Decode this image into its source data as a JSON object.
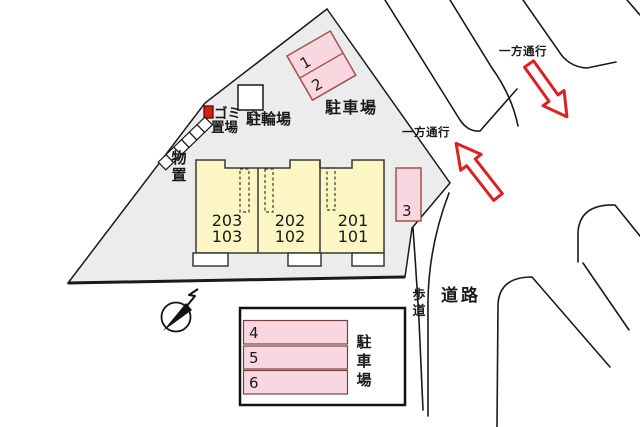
{
  "title": "site-plan",
  "colors": {
    "property_fill": "#ececec",
    "unit_fill": "#fcf6c5",
    "stall_fill": "#f8d7e1",
    "stall_border": "#a0524a",
    "arrow_red": "#dd2020",
    "garbage_red": "#cc2222",
    "line": "#1a1a1a"
  },
  "building": {
    "units": [
      {
        "upper": "203",
        "lower": "103"
      },
      {
        "upper": "202",
        "lower": "102"
      },
      {
        "upper": "201",
        "lower": "101"
      }
    ]
  },
  "labels": {
    "parking_top": "駐車場",
    "parking_bottom": "駐車場",
    "bicycle_shed": "駐輪場",
    "garbage_line1": "ゴミ",
    "garbage_line2": "置場",
    "storage": "物置",
    "one_way_top": "一方通行",
    "one_way_left": "一方通行",
    "road": "道路",
    "sidewalk": "歩道"
  },
  "stalls": {
    "s1": "1",
    "s2": "2",
    "s3": "3",
    "s4": "4",
    "s5": "5",
    "s6": "6"
  }
}
